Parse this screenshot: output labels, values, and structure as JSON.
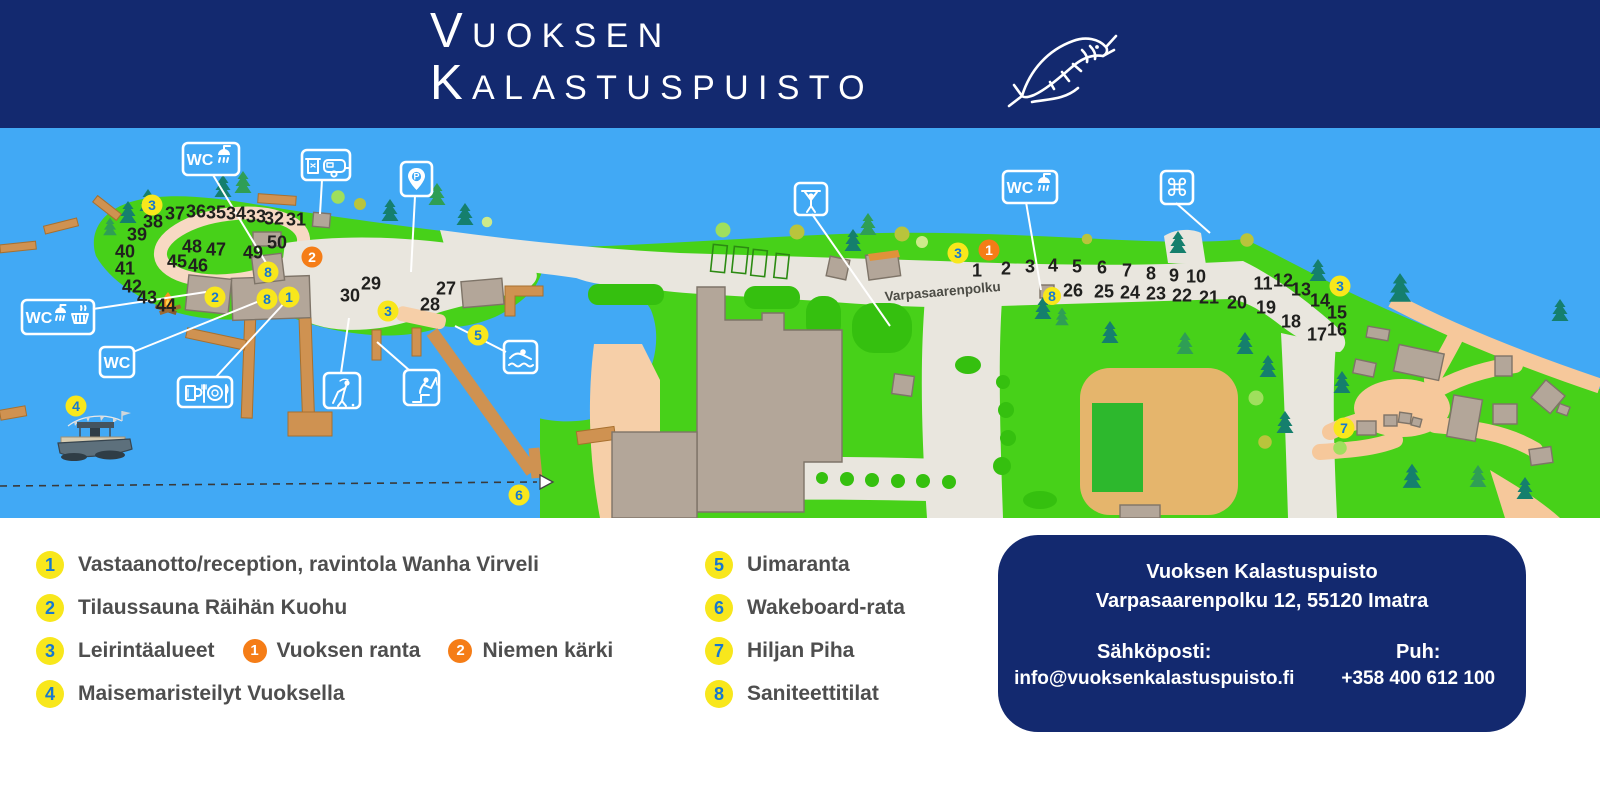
{
  "header": {
    "title_line1": "Vuoksen",
    "title_line2": "Kalastuspuisto"
  },
  "colors": {
    "header_navy": "#13296f",
    "water_blue": "#41a9f5",
    "land_green": "#47d119",
    "marker_yellow": "#f8e71c",
    "marker_orange": "#f57d17",
    "marker_number_blue": "#1778d0"
  },
  "map": {
    "street_label": "Varpasaarenpolku",
    "labels": {
      "wc": "WC",
      "parking_p": "P",
      "attraction_symbol": "⌘"
    },
    "icon_signs": [
      "wc-shower-sign-island",
      "waste-caravan-sign",
      "parking-pin-sign",
      "wc-shower-dishwashing-sign",
      "wc-sign",
      "restaurant-beer-sign",
      "swimming-sign",
      "golf-sign",
      "fishing-sign",
      "outdoor-gym-sign",
      "wc-shower-sign-east",
      "tourist-attraction-sign"
    ],
    "site_numbers": [
      {
        "n": "1",
        "x": 977,
        "y": 270
      },
      {
        "n": "2",
        "x": 1006,
        "y": 268
      },
      {
        "n": "3",
        "x": 1030,
        "y": 266
      },
      {
        "n": "4",
        "x": 1053,
        "y": 265
      },
      {
        "n": "5",
        "x": 1077,
        "y": 266
      },
      {
        "n": "6",
        "x": 1102,
        "y": 267
      },
      {
        "n": "7",
        "x": 1127,
        "y": 270
      },
      {
        "n": "8",
        "x": 1151,
        "y": 273
      },
      {
        "n": "9",
        "x": 1174,
        "y": 275
      },
      {
        "n": "10",
        "x": 1196,
        "y": 276
      },
      {
        "n": "11",
        "x": 1263,
        "y": 283
      },
      {
        "n": "12",
        "x": 1283,
        "y": 280
      },
      {
        "n": "13",
        "x": 1301,
        "y": 289
      },
      {
        "n": "14",
        "x": 1320,
        "y": 300
      },
      {
        "n": "15",
        "x": 1337,
        "y": 312
      },
      {
        "n": "16",
        "x": 1337,
        "y": 329
      },
      {
        "n": "17",
        "x": 1317,
        "y": 334
      },
      {
        "n": "18",
        "x": 1291,
        "y": 321
      },
      {
        "n": "19",
        "x": 1266,
        "y": 307
      },
      {
        "n": "20",
        "x": 1237,
        "y": 302
      },
      {
        "n": "21",
        "x": 1209,
        "y": 297
      },
      {
        "n": "22",
        "x": 1182,
        "y": 295
      },
      {
        "n": "23",
        "x": 1156,
        "y": 293
      },
      {
        "n": "24",
        "x": 1130,
        "y": 292
      },
      {
        "n": "25",
        "x": 1104,
        "y": 291
      },
      {
        "n": "26",
        "x": 1073,
        "y": 290
      },
      {
        "n": "27",
        "x": 446,
        "y": 288
      },
      {
        "n": "28",
        "x": 430,
        "y": 304
      },
      {
        "n": "29",
        "x": 371,
        "y": 283
      },
      {
        "n": "30",
        "x": 350,
        "y": 295
      },
      {
        "n": "31",
        "x": 296,
        "y": 219
      },
      {
        "n": "32",
        "x": 274,
        "y": 218
      },
      {
        "n": "33",
        "x": 256,
        "y": 216
      },
      {
        "n": "34",
        "x": 236,
        "y": 213
      },
      {
        "n": "35",
        "x": 216,
        "y": 212
      },
      {
        "n": "36",
        "x": 196,
        "y": 211
      },
      {
        "n": "37",
        "x": 175,
        "y": 213
      },
      {
        "n": "38",
        "x": 153,
        "y": 221
      },
      {
        "n": "39",
        "x": 137,
        "y": 234
      },
      {
        "n": "40",
        "x": 125,
        "y": 251
      },
      {
        "n": "41",
        "x": 125,
        "y": 268
      },
      {
        "n": "42",
        "x": 132,
        "y": 286
      },
      {
        "n": "43",
        "x": 147,
        "y": 297
      },
      {
        "n": "44",
        "x": 166,
        "y": 305
      },
      {
        "n": "45",
        "x": 177,
        "y": 261
      },
      {
        "n": "46",
        "x": 198,
        "y": 265
      },
      {
        "n": "47",
        "x": 216,
        "y": 249
      },
      {
        "n": "48",
        "x": 192,
        "y": 246
      },
      {
        "n": "49",
        "x": 253,
        "y": 252
      },
      {
        "n": "50",
        "x": 277,
        "y": 242
      }
    ],
    "markers": [
      {
        "n": "3",
        "x": 152,
        "y": 205,
        "color": "yellow"
      },
      {
        "n": "2",
        "x": 215,
        "y": 297,
        "color": "yellow"
      },
      {
        "n": "8",
        "x": 268,
        "y": 272,
        "color": "yellow"
      },
      {
        "n": "8",
        "x": 267,
        "y": 299,
        "color": "yellow"
      },
      {
        "n": "1",
        "x": 289,
        "y": 297,
        "color": "yellow"
      },
      {
        "n": "3",
        "x": 388,
        "y": 311,
        "color": "yellow"
      },
      {
        "n": "5",
        "x": 478,
        "y": 335,
        "color": "yellow"
      },
      {
        "n": "4",
        "x": 76,
        "y": 406,
        "color": "yellow"
      },
      {
        "n": "6",
        "x": 519,
        "y": 495,
        "color": "yellow"
      },
      {
        "n": "3",
        "x": 958,
        "y": 253,
        "color": "yellow"
      },
      {
        "n": "8",
        "x": 1052,
        "y": 296,
        "color": "yellow",
        "r": 9
      },
      {
        "n": "3",
        "x": 1340,
        "y": 286,
        "color": "yellow"
      },
      {
        "n": "7",
        "x": 1344,
        "y": 428,
        "color": "yellow"
      },
      {
        "n": "2",
        "x": 312,
        "y": 257,
        "color": "orange"
      },
      {
        "n": "1",
        "x": 989,
        "y": 250,
        "color": "orange"
      }
    ]
  },
  "legend": {
    "items": [
      {
        "num": "1",
        "label": "Vastaanotto/reception, ravintola Wanha Virveli"
      },
      {
        "num": "2",
        "label": "Tilaussauna Räihän Kuohu"
      },
      {
        "num": "3",
        "label": "Leirintäalueet"
      },
      {
        "num": "4",
        "label": "Maisemaristeilyt Vuoksella"
      },
      {
        "num": "5",
        "label": "Uimaranta"
      },
      {
        "num": "6",
        "label": "Wakeboard-rata"
      },
      {
        "num": "7",
        "label": "Hiljan Piha"
      },
      {
        "num": "8",
        "label": "Saniteettitilat"
      }
    ],
    "sub_markers": [
      {
        "num": "1",
        "label": "Vuoksen ranta"
      },
      {
        "num": "2",
        "label": "Niemen kärki"
      }
    ]
  },
  "contact": {
    "name": "Vuoksen Kalastuspuisto",
    "address": "Varpasaarenpolku 12, 55120 Imatra",
    "email_label": "Sähköposti:",
    "email": "info@vuoksenkalastuspuisto.fi",
    "phone_label": "Puh:",
    "phone": "+358 400 612 100"
  }
}
